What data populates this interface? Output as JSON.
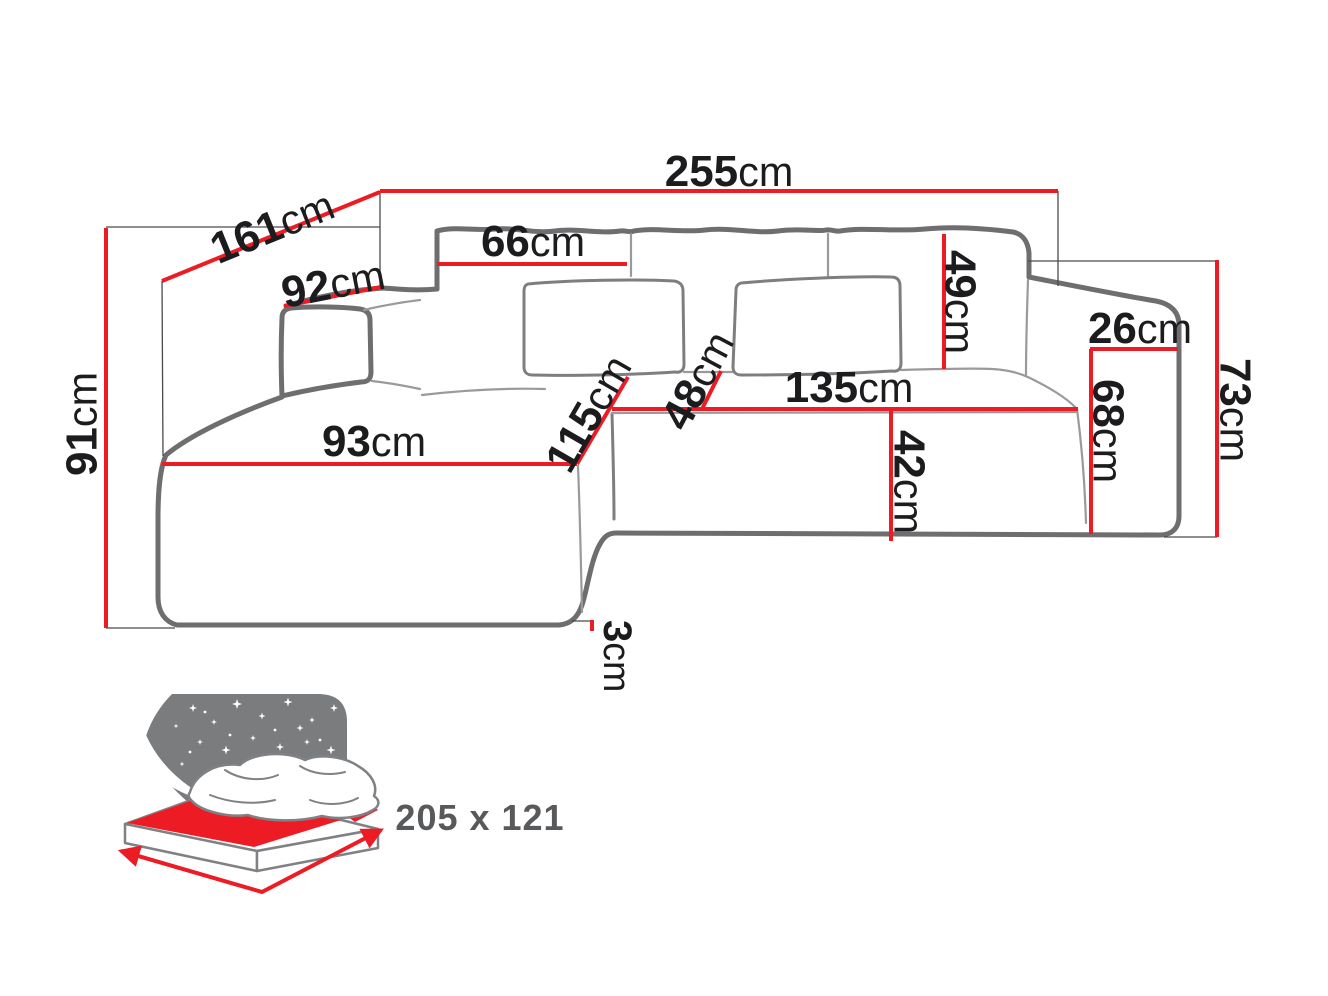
{
  "diagram": {
    "title": "corner-sofa-dimension-diagram",
    "unit": "cm",
    "dims": {
      "width_total": {
        "value": "255",
        "unit": "cm"
      },
      "depth_diagonal": {
        "value": "161",
        "unit": "cm"
      },
      "armrest_left_top": {
        "value": "92",
        "unit": "cm"
      },
      "height_total": {
        "value": "91",
        "unit": "cm"
      },
      "back_cushion_width": {
        "value": "66",
        "unit": "cm"
      },
      "back_cushion_height": {
        "value": "49",
        "unit": "cm"
      },
      "armrest_right_width": {
        "value": "26",
        "unit": "cm"
      },
      "armrest_right_height": {
        "value": "73",
        "unit": "cm"
      },
      "armrest_front_height": {
        "value": "68",
        "unit": "cm"
      },
      "seat_width": {
        "value": "135",
        "unit": "cm"
      },
      "seat_depth_back": {
        "value": "48",
        "unit": "cm"
      },
      "seat_height": {
        "value": "42",
        "unit": "cm"
      },
      "chaise_length": {
        "value": "115",
        "unit": "cm"
      },
      "chaise_width": {
        "value": "93",
        "unit": "cm"
      },
      "leg_clearance": {
        "value": "3",
        "unit": "cm"
      }
    },
    "sleeping_area": {
      "label": "205 x 121"
    },
    "colors": {
      "dimension_red": "#ed1c24",
      "outline_gray": "#6e6e70",
      "text_black": "#1c1c1e",
      "label_gray": "#58595b"
    }
  }
}
